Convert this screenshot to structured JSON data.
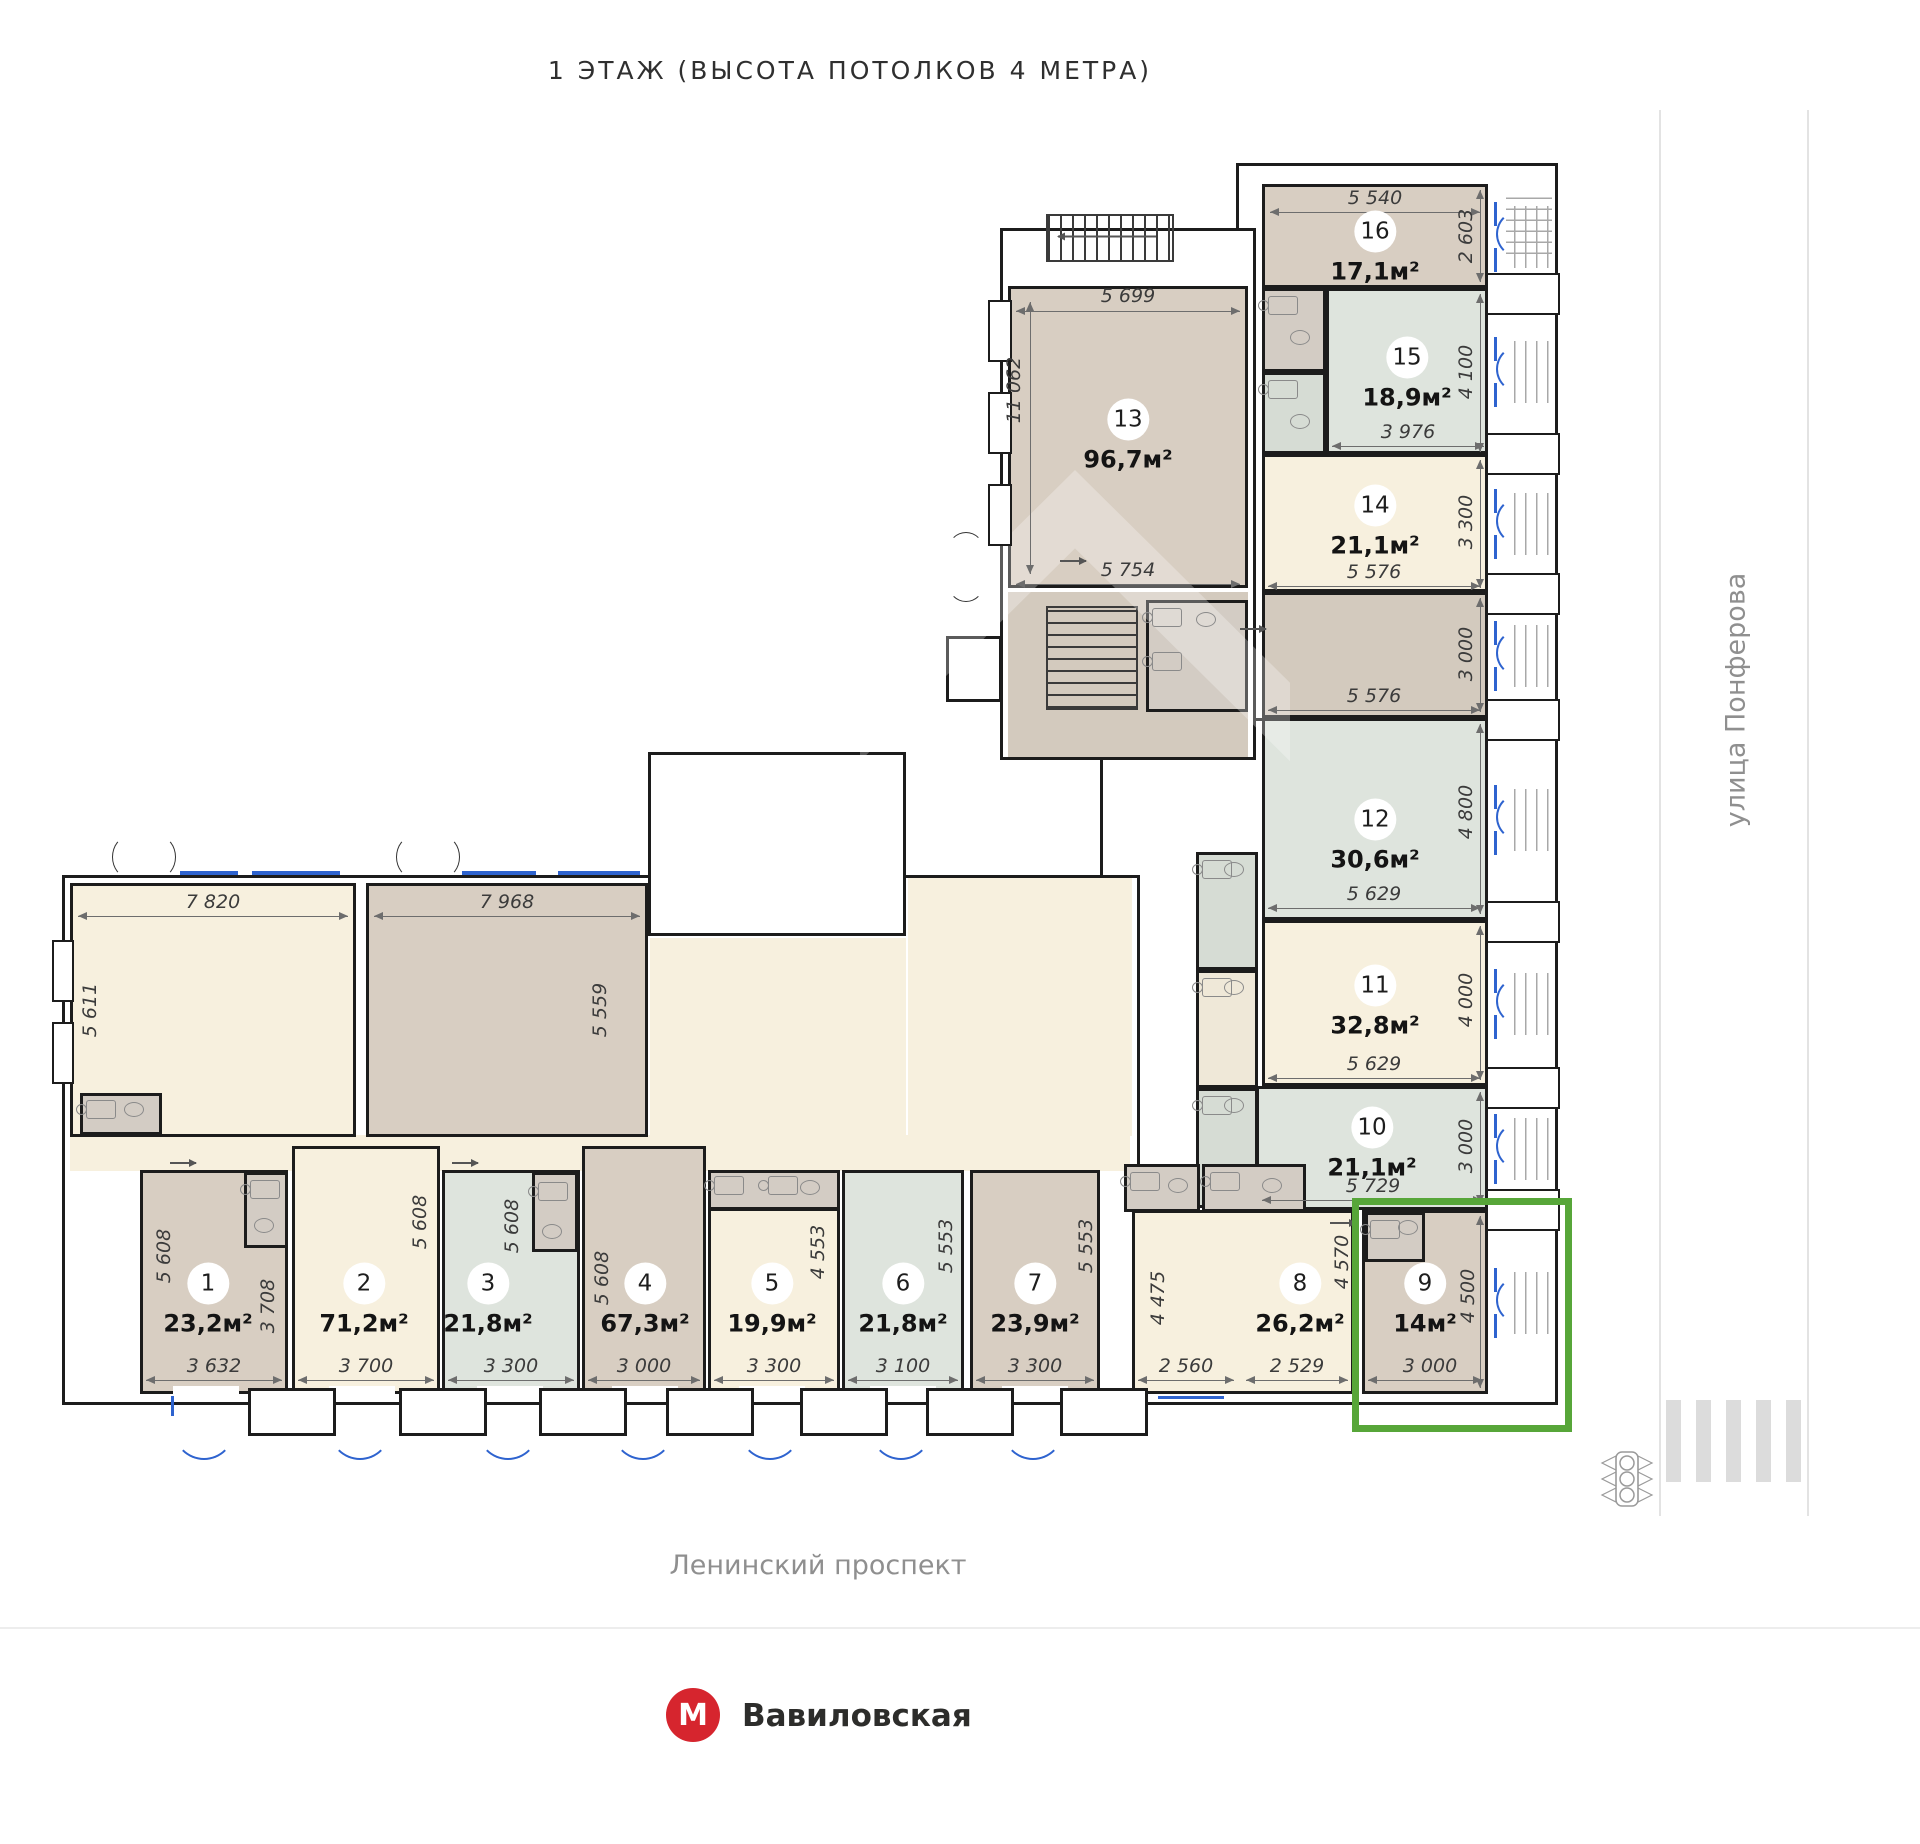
{
  "title": "1 ЭТАЖ (ВЫСОТА ПОТОЛКОВ 4 МЕТРА)",
  "streets": {
    "right": "улица Понферова",
    "bottom": "Ленинский проспект"
  },
  "metro": {
    "letter": "М",
    "name": "Вавиловская",
    "color": "#d6252e"
  },
  "highlight_color": "#57a639",
  "rooms": [
    {
      "number": "1",
      "area": "23,2м²"
    },
    {
      "number": "2",
      "area": "71,2м²"
    },
    {
      "number": "3",
      "area": "21,8м²"
    },
    {
      "number": "4",
      "area": "67,3м²"
    },
    {
      "number": "5",
      "area": "19,9м²"
    },
    {
      "number": "6",
      "area": "21,8м²"
    },
    {
      "number": "7",
      "area": "23,9м²"
    },
    {
      "number": "8",
      "area": "26,2м²"
    },
    {
      "number": "9",
      "area": "14м²"
    },
    {
      "number": "10",
      "area": "21,1м²"
    },
    {
      "number": "11",
      "area": "32,8м²"
    },
    {
      "number": "12",
      "area": "30,6м²"
    },
    {
      "number": "13",
      "area": "96,7м²"
    },
    {
      "number": "14",
      "area": "21,1м²"
    },
    {
      "number": "15",
      "area": "18,9м²"
    },
    {
      "number": "16",
      "area": "17,1м²"
    }
  ],
  "dims": {
    "r1_h": "5 608",
    "r1_h2": "3 708",
    "r1_w": "3 632",
    "r2_h": "5 608",
    "r2_w": "3 700",
    "r3_h": "5 608",
    "r3_w": "3 300",
    "r4_h": "5 608",
    "r4_w": "3 000",
    "r5_h": "4 553",
    "r5_w": "3 300",
    "r6_h": "5 553",
    "r6_w": "3 100",
    "r7_h": "5 553",
    "r7_w": "3 300",
    "r8_h1": "4 475",
    "r8_h2": "4 570",
    "r8_w1": "2 560",
    "r8_w2": "2 529",
    "r9_h": "4 500",
    "r9_w": "3 000",
    "r10_h": "3 000",
    "r10_w": "5 729",
    "r11_h": "4 000",
    "r11_w": "5 629",
    "r12_h": "4 800",
    "r12_w": "5 629",
    "r13_w": "5 699",
    "r13_h": "11 062",
    "r13_w2": "5 754",
    "r14_h": "3 300",
    "r14_w": "5 576",
    "r15_h": "4 100",
    "r15_w": "3 976",
    "r16_w": "5 540",
    "r16_h": "2 603",
    "hall_h": "3 000",
    "hall_w": "5 576",
    "hl_w": "7 820",
    "hl_h": "5 611",
    "hr_w": "7 968",
    "hr_h": "5 559"
  }
}
